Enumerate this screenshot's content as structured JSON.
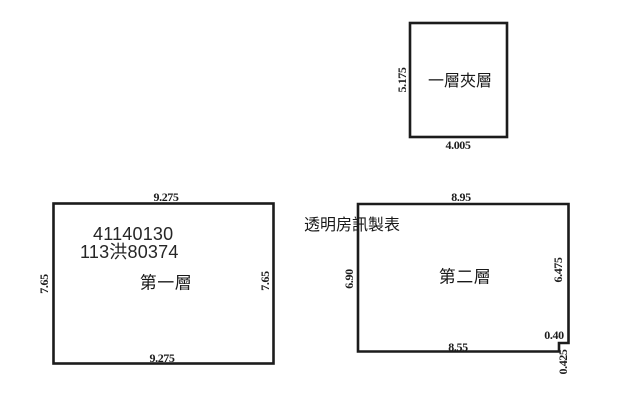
{
  "canvas": {
    "background": "#ffffff",
    "line_color": "#1c1c1c",
    "text_color": "#1a1a1a"
  },
  "note": {
    "maker_label": "透明房訊製表"
  },
  "floors": {
    "mezzanine": {
      "label": "一層夾層",
      "dim_left": "5.175",
      "dim_bottom": "4.005"
    },
    "first": {
      "label": "第一層",
      "id_line1": "41140130",
      "id_line2": "113洪80374",
      "dim_top": "9.275",
      "dim_bottom": "9.275",
      "dim_left": "7.65",
      "dim_right": "7.65"
    },
    "second": {
      "label": "第二層",
      "dim_top": "8.95",
      "dim_bottom": "8.55",
      "dim_left": "6.90",
      "dim_right": "6.475",
      "dim_notch_width": "0.40",
      "dim_notch_height": "0.425"
    }
  }
}
